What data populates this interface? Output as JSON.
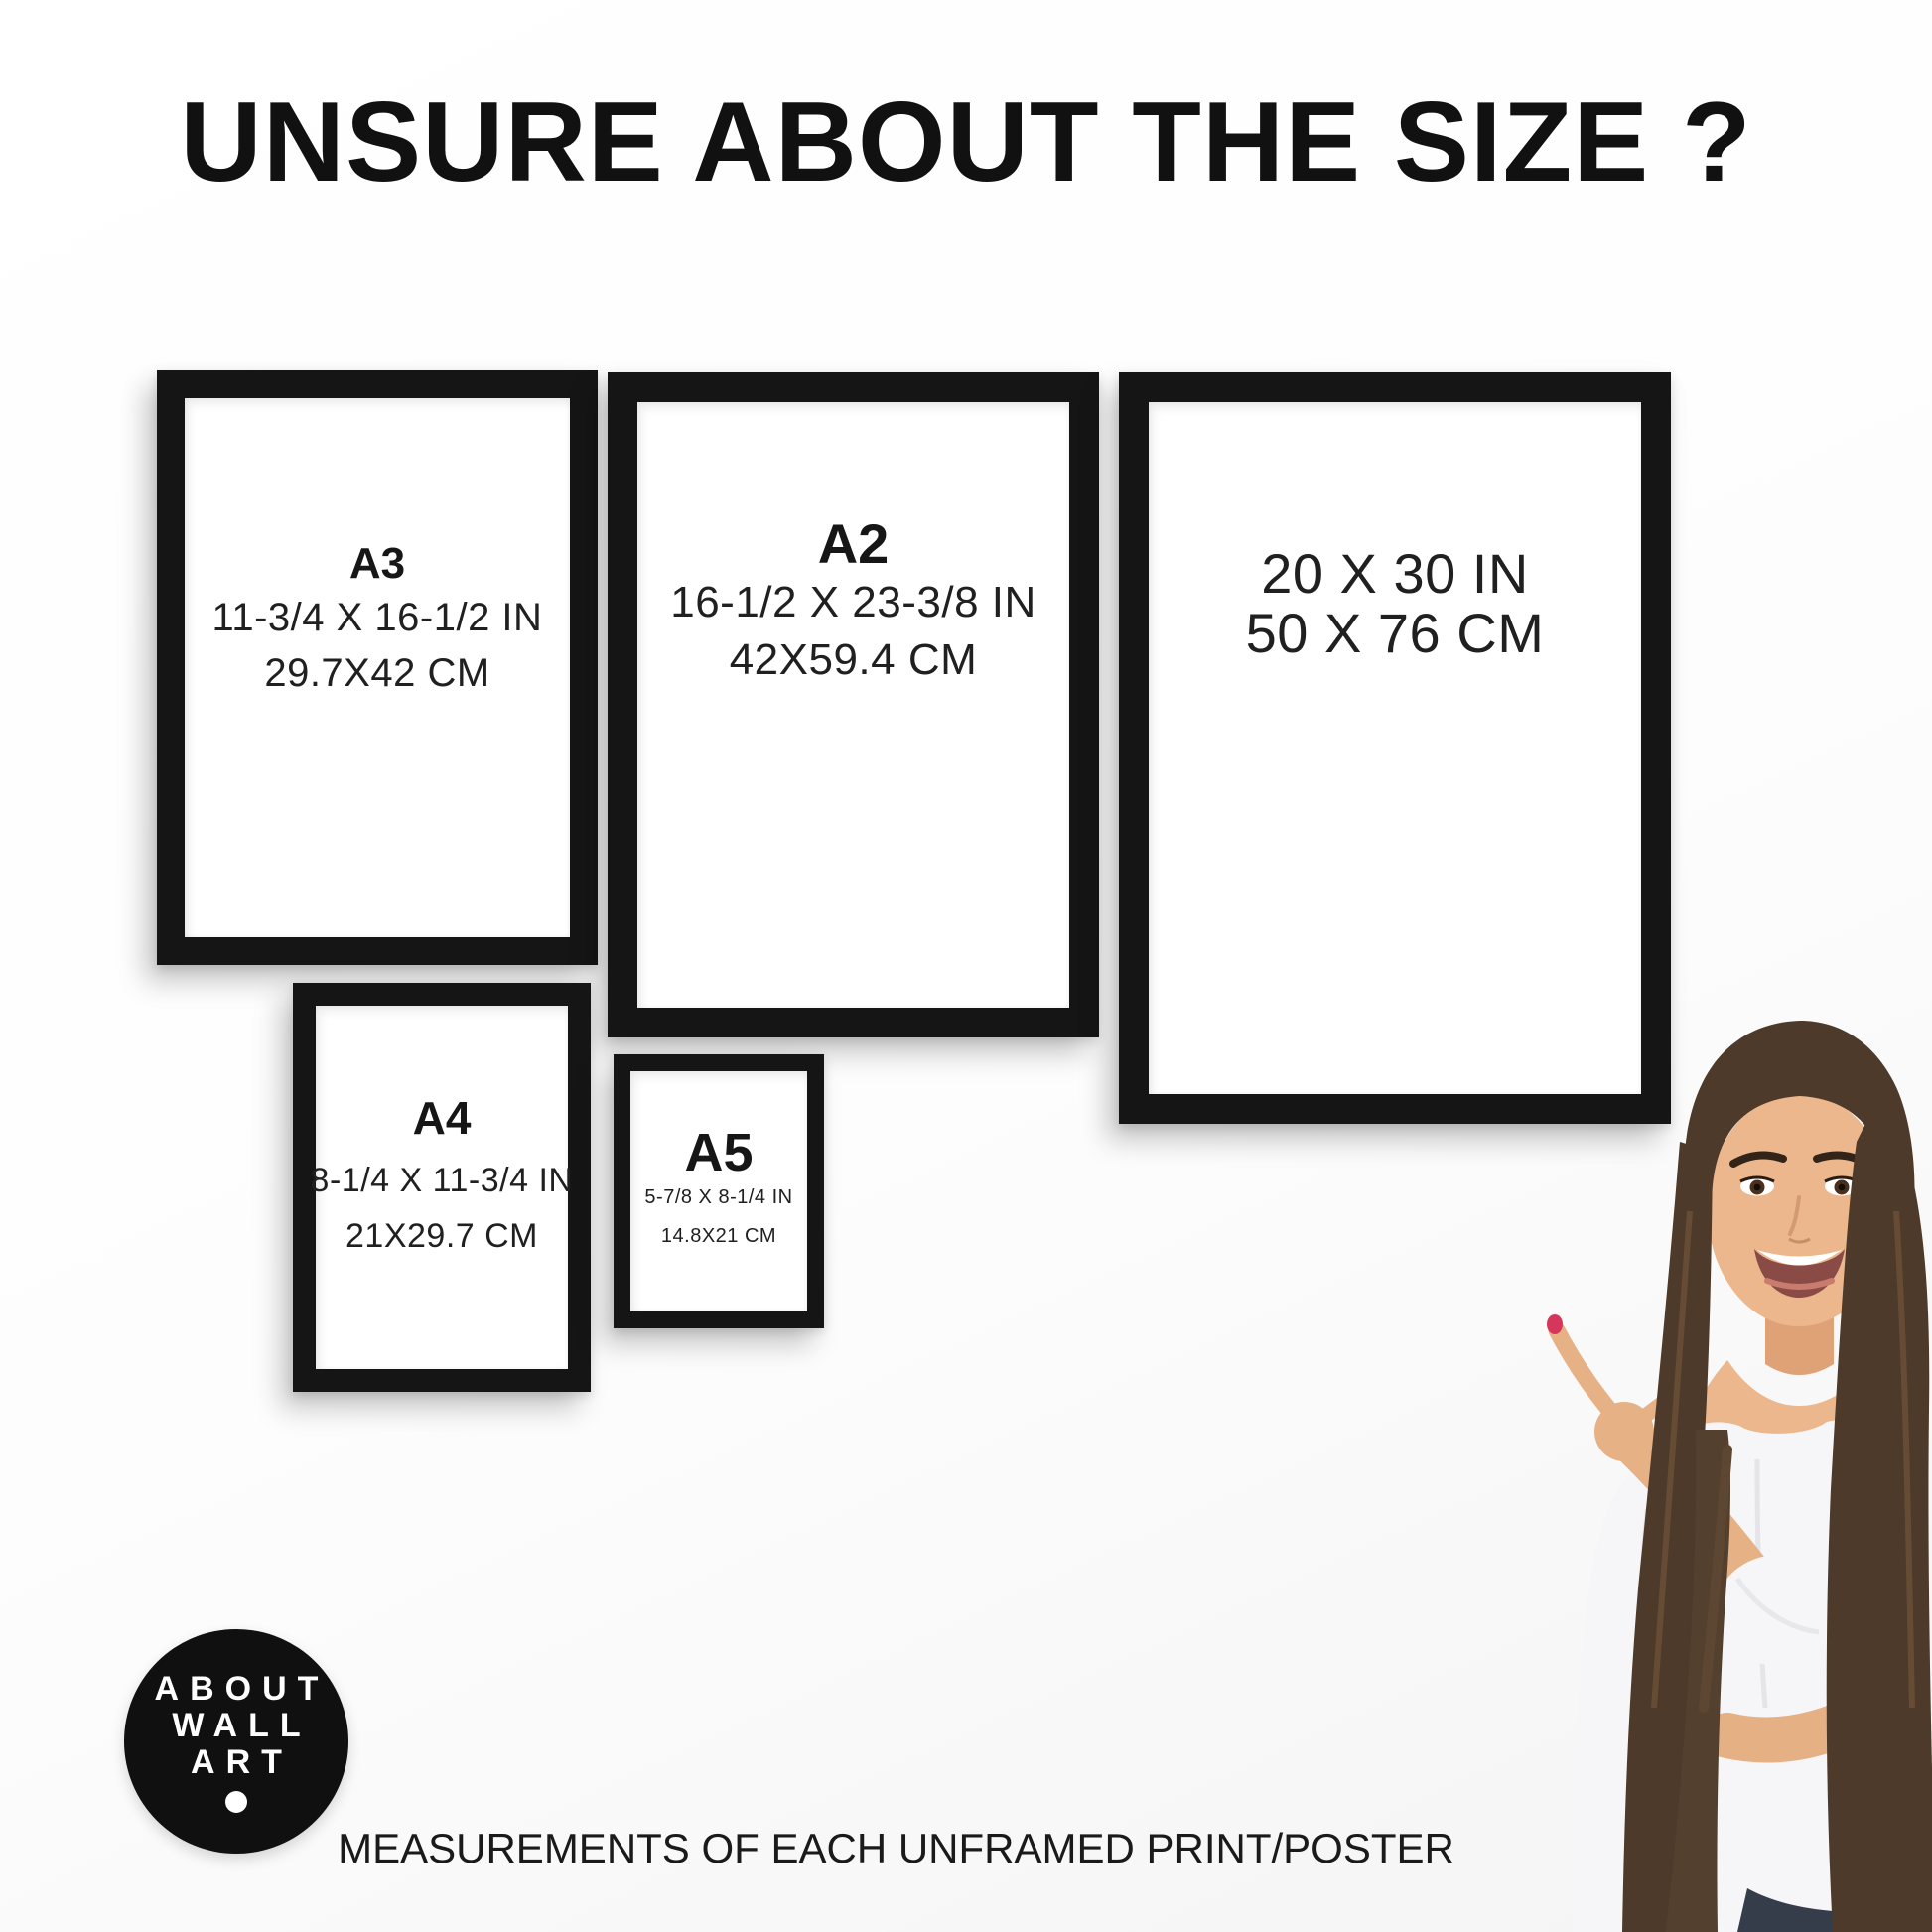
{
  "title": "UNSURE ABOUT THE SIZE ?",
  "frames": [
    {
      "id": "a3",
      "label": "A3",
      "inches": "11-3/4 X 16-1/2 IN",
      "cm": "29.7X42 CM"
    },
    {
      "id": "a2",
      "label": "A2",
      "inches": "16-1/2 X 23-3/8 IN",
      "cm": "42X59.4 CM"
    },
    {
      "id": "2030",
      "label": "",
      "inches": "20 X 30 IN",
      "cm": "50 X 76 CM"
    },
    {
      "id": "a4",
      "label": "A4",
      "inches": "8-1/4 X 11-3/4 IN",
      "cm": "21X29.7 CM"
    },
    {
      "id": "a5",
      "label": "A5",
      "inches": "5-7/8 X 8-1/4 IN",
      "cm": "14.8X21 CM"
    }
  ],
  "logo": {
    "lines": [
      "ABOUT",
      "WALL",
      "ART"
    ]
  },
  "footer": {
    "caption": "MEASUREMENTS OF EACH UNFRAMED PRINT/POSTER"
  },
  "colors": {
    "background": "#ffffff",
    "frame": "#151515",
    "text": "#1d1d1d",
    "logo_background": "#101010",
    "logo_text": "#ffffff",
    "nail_polish": "#d6355c"
  }
}
